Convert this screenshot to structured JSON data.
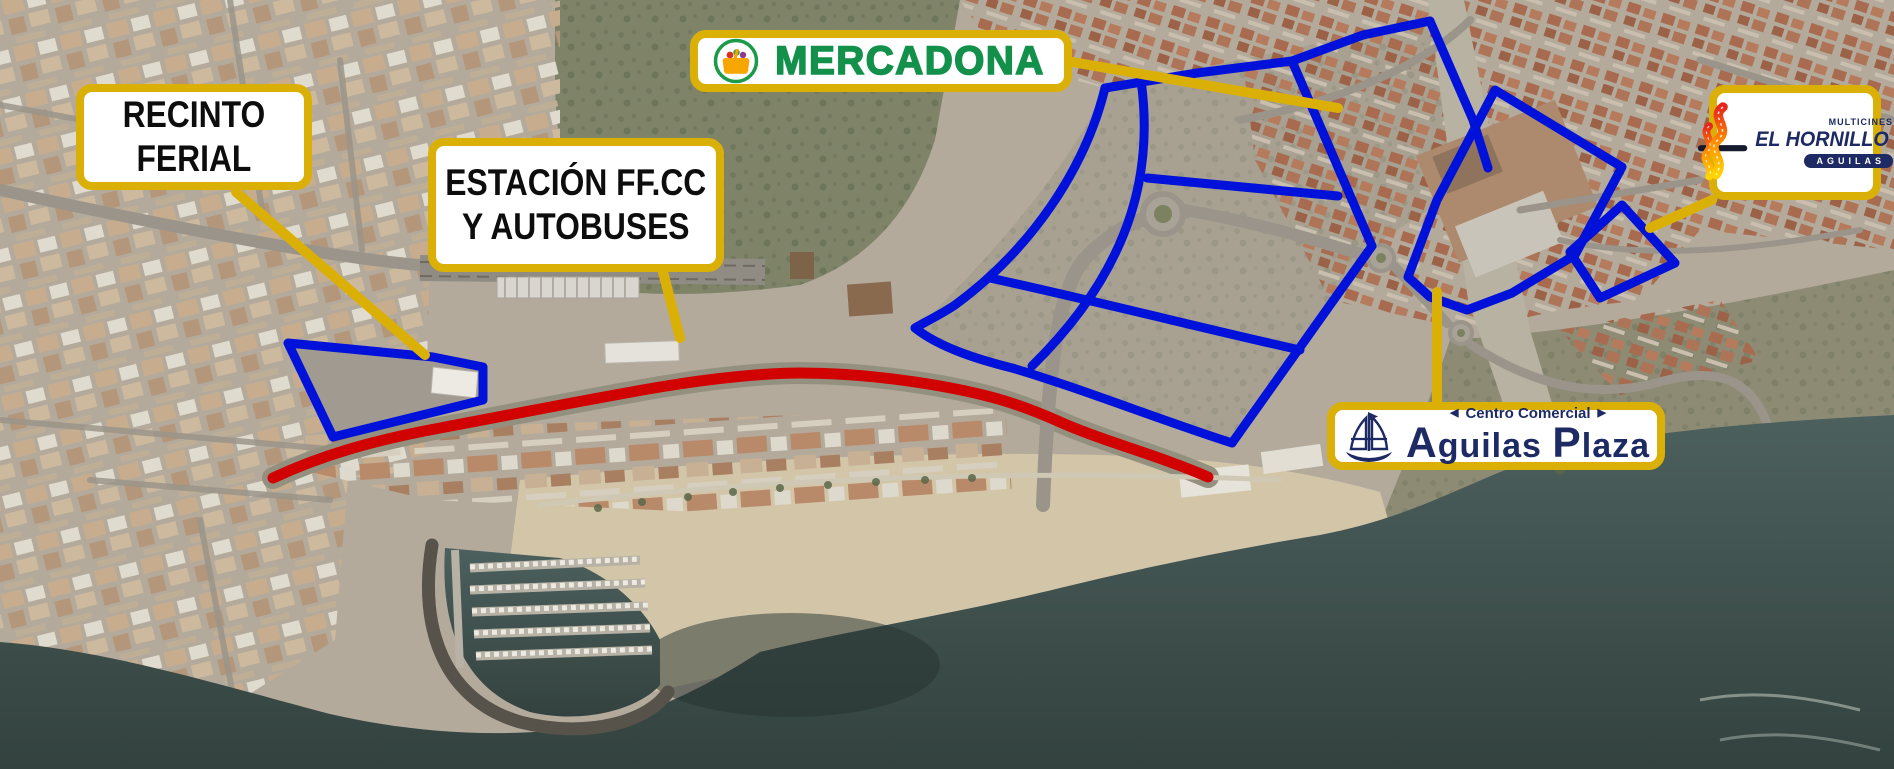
{
  "map": {
    "colors": {
      "zone_outline_blue": "#0011d9",
      "route_red": "#d10202",
      "connector_gold": "#dbb006",
      "label_border_gold": "#dbb006",
      "logo_navy": "#1d2a63",
      "mercadona_green": "#13914b",
      "mercadona_orange": "#f7a600"
    },
    "icons": {
      "mercadona": "shopping-basket-icon",
      "aguilas_plaza": "sailboat-icon",
      "el_hornillo": "film-flame-icon"
    }
  },
  "labels": {
    "recinto_ferial": {
      "line1": "RECINTO",
      "line2": "FERIAL"
    },
    "estacion": {
      "line1": "ESTACIÓN FF.CC",
      "line2": "Y AUTOBUSES"
    },
    "mercadona": {
      "name": "MERCADONA"
    },
    "aguilas_plaza": {
      "tri_left": "◀",
      "kicker": "Centro Comercial",
      "tri_right": "▶",
      "word1": "Aguilas",
      "word2": "Plaza"
    },
    "el_hornillo": {
      "kicker": "MULTICINES",
      "name": "EL HORNILLO",
      "sub": "AGUILAS"
    }
  }
}
